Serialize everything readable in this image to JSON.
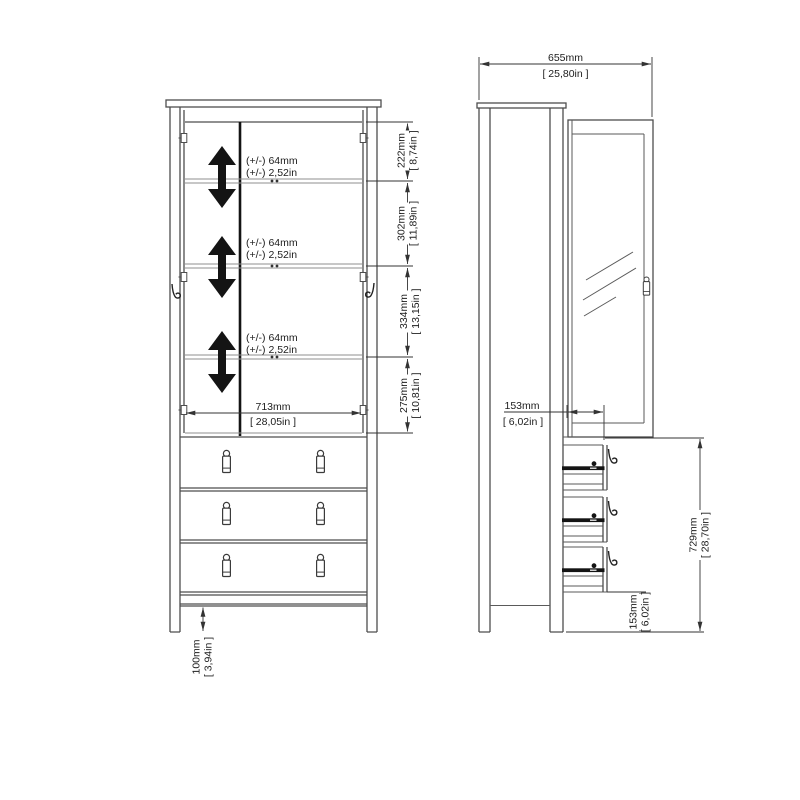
{
  "front": {
    "adjustable_shelf_labels": [
      {
        "mm": "(+/-) 64mm",
        "in": "(+/-) 2,52in"
      },
      {
        "mm": "(+/-) 64mm",
        "in": "(+/-) 2,52in"
      },
      {
        "mm": "(+/-) 64mm",
        "in": "(+/-) 2,52in"
      }
    ],
    "dims": {
      "shelf_top": {
        "mm": "222mm",
        "in": "[ 8,74in ]"
      },
      "shelf_second": {
        "mm": "302mm",
        "in": "[ 11,89in ]"
      },
      "shelf_third": {
        "mm": "334mm",
        "in": "[ 13,15in ]"
      },
      "shelf_bottom": {
        "mm": "275mm",
        "in": "[ 10,81in ]"
      },
      "interior_width": {
        "mm": "713mm",
        "in": "[ 28,05in ]"
      },
      "leg_height": {
        "mm": "100mm",
        "in": "[ 3,94in ]"
      }
    }
  },
  "side": {
    "dims": {
      "depth": {
        "mm": "655mm",
        "in": "[ 25,80in ]"
      },
      "drawer_extension": {
        "mm": "153mm",
        "in": "[ 6,02in ]"
      },
      "drawer_section": {
        "mm": "729mm",
        "in": "[ 28,70in ]"
      },
      "base_height": {
        "mm": "153mm",
        "in": "[ 6,02in ]"
      }
    }
  }
}
